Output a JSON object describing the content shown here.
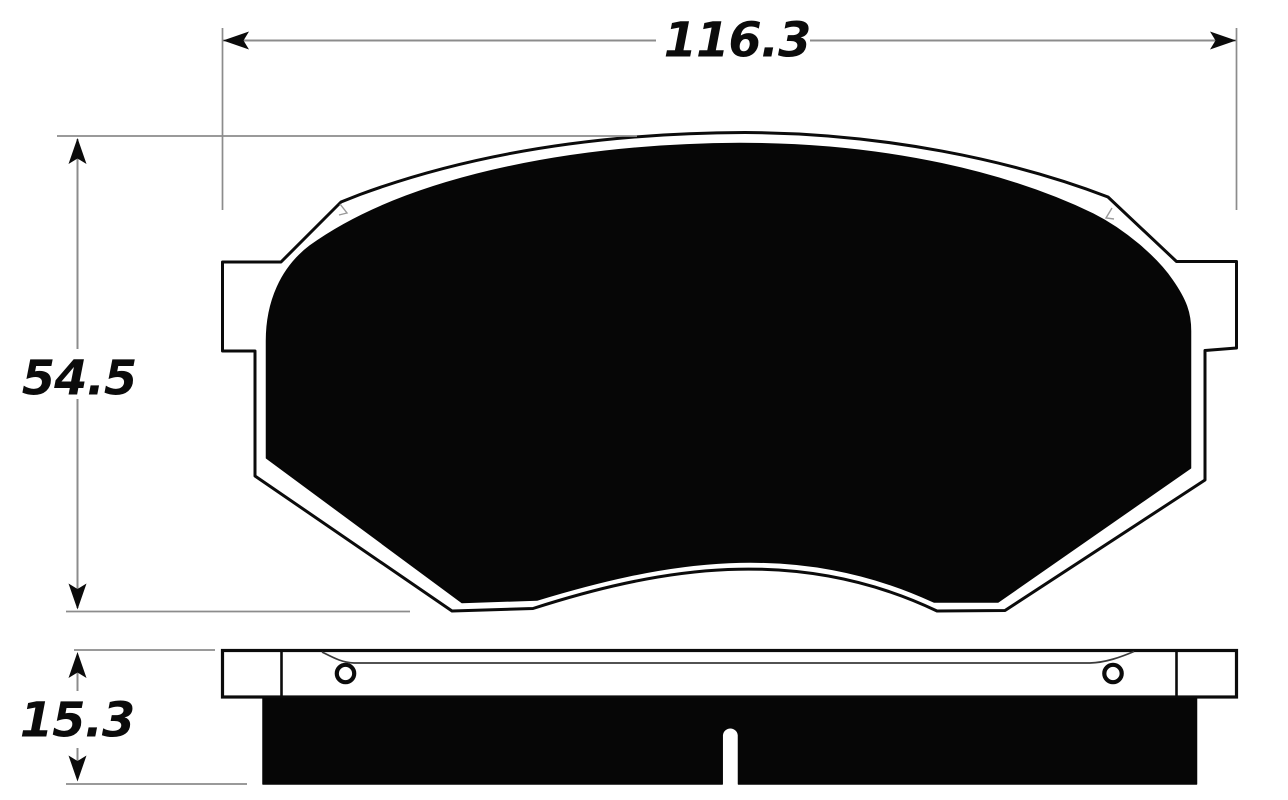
{
  "diagram": {
    "type": "technical-drawing",
    "subject": "brake pad dimensional drawing, front profile and side (edge) views",
    "views": {
      "front_view": {
        "description": "brake pad front profile with backing-plate outline, side mounting tabs and black friction area",
        "width_dimension": {
          "label": "116.3"
        },
        "height_dimension": {
          "label": "54.5"
        }
      },
      "side_view": {
        "description": "edge view showing backing plate with two rivet holes and friction material block with center wear slot",
        "thickness_dimension": {
          "label": "15.3"
        }
      }
    },
    "colors": {
      "ink": "#0b0b0b",
      "dimension_lines": "#8c8c8c",
      "background": "#ffffff"
    }
  }
}
